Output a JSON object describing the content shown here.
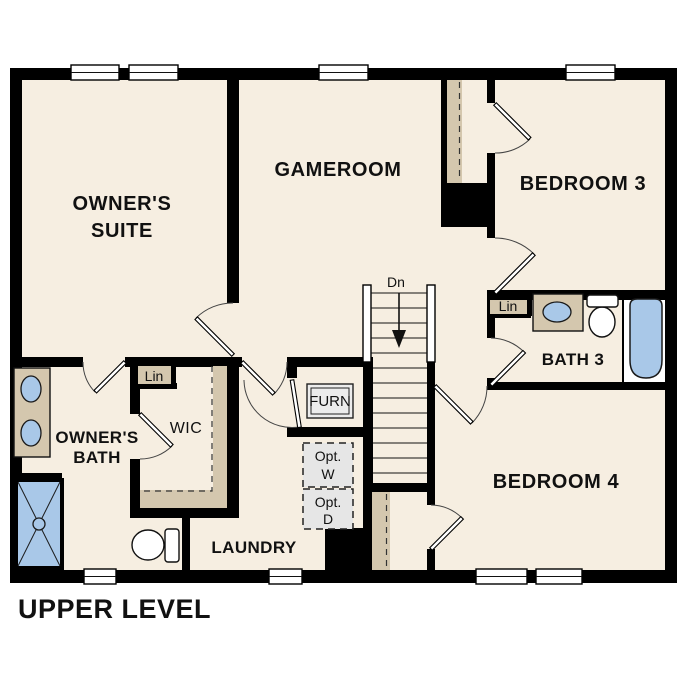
{
  "title": "UPPER LEVEL",
  "colors": {
    "floor": "#f6eee1",
    "wall": "#000000",
    "casework": "#d4c7ae",
    "fixture": "#a9c8e8",
    "optional": "#e6e6e6",
    "text": "#111111"
  },
  "rooms": {
    "owners_suite": {
      "line1": "OWNER'S",
      "line2": "SUITE"
    },
    "gameroom": {
      "label": "GAMEROOM"
    },
    "bedroom3": {
      "label": "BEDROOM 3"
    },
    "bath3": {
      "label": "BATH 3"
    },
    "bedroom4": {
      "label": "BEDROOM 4"
    },
    "owners_bath": {
      "line1": "OWNER'S",
      "line2": "BATH"
    },
    "wic": {
      "label": "WIC"
    },
    "laundry": {
      "label": "LAUNDRY"
    }
  },
  "annotations": {
    "stairs_down": "Dn",
    "furnace": "FURN",
    "opt_washer_line1": "Opt.",
    "opt_washer_line2": "W",
    "opt_dryer_line1": "Opt.",
    "opt_dryer_line2": "D",
    "linen_wic": "Lin",
    "linen_bath3": "Lin"
  }
}
